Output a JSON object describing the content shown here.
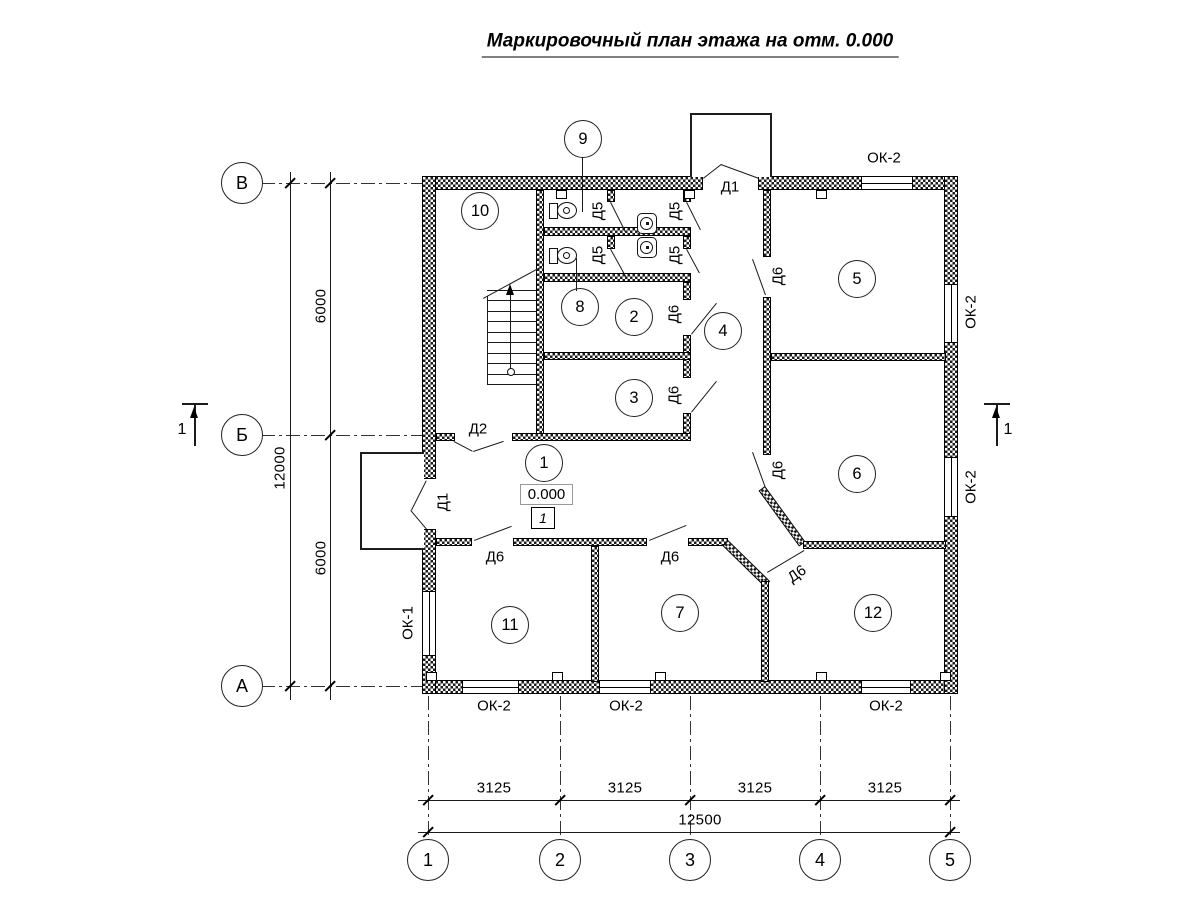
{
  "title": "Маркировочный план этажа на отм. 0.000",
  "axes": {
    "columns": [
      "1",
      "2",
      "3",
      "4",
      "5"
    ],
    "rows": [
      "В",
      "Б",
      "А"
    ]
  },
  "dimensions": {
    "column_spans": [
      "3125",
      "3125",
      "3125",
      "3125"
    ],
    "column_total": "12500",
    "row_span_upper": "6000",
    "row_span_lower": "6000",
    "row_total": "12000"
  },
  "rooms": [
    "1",
    "2",
    "3",
    "4",
    "5",
    "6",
    "7",
    "8",
    "9",
    "10",
    "11",
    "12"
  ],
  "marks": {
    "elevation": "0.000",
    "floor_type": "1",
    "section": "1"
  },
  "labels": {
    "d1": "Д1",
    "d2": "Д2",
    "d5": "Д5",
    "d6": "Д6",
    "ok1": "ОК-1",
    "ok2": "ОК-2"
  }
}
